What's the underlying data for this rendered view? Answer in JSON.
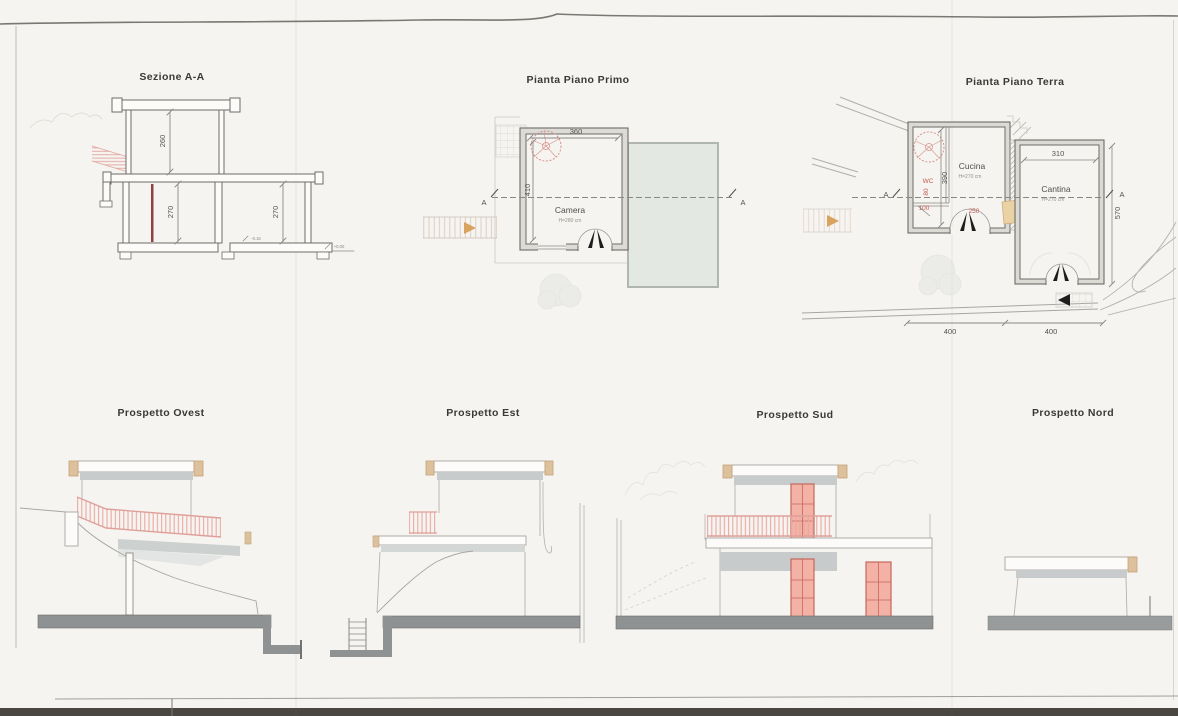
{
  "sheet": {
    "kind": "scanned architectural drawing sheet"
  },
  "colors": {
    "paper": "#f6f4f0",
    "line_dark": "#6e6c68",
    "line_light": "#a8a6a2",
    "title_ink": "#3b3936",
    "dim_ink": "#55534f",
    "red_ink": "#c05b52",
    "door_pink": "#f3b2a5",
    "door_outline": "#c4685c",
    "railing_pink": "#e9a9a2",
    "roof_tan": "#ddc09c",
    "fascia_gray": "#c7cbcc",
    "fascia_gray_light": "#d3d7d6",
    "terrace_gray": "#e4e8e3",
    "ground_gray": "#8e9293",
    "ground_gray_light": "#989c9d",
    "arrow_orange": "#d8a35e",
    "door_red_section": "#8f4341",
    "scan_edge_dark": "#4a4742"
  },
  "sezione": {
    "title": "Sezione A-A",
    "dim_upper": "260",
    "dim_lower_left": "270",
    "dim_lower_right": "270",
    "level_left": "-0.15",
    "level_right": "+0.00"
  },
  "primo": {
    "title": "Pianta Piano Primo",
    "dim_width": "360",
    "dim_depth": "410",
    "room_name": "Camera",
    "room_height": "H=280 cm",
    "section_a_left": "A",
    "section_a_right": "A"
  },
  "terra": {
    "title": "Pianta Piano Terra",
    "cucina_name": "Cucina",
    "cucina_height": "H=270 cm",
    "cantina_name": "Cantina",
    "cantina_height": "H=270 cm",
    "wc_label": "WC",
    "dim_wc_width": "80",
    "dim_entry": "100",
    "dim_door": "250",
    "dim_cucina_depth": "390",
    "dim_cantina_width": "310",
    "dim_site_depth": "570",
    "dim_bottom_left": "400",
    "dim_bottom_right": "400",
    "section_a_left": "A",
    "section_a_right": "A"
  },
  "ovest": {
    "title": "Prospetto Ovest"
  },
  "est": {
    "title": "Prospetto Est"
  },
  "sud": {
    "title": "Prospetto Sud"
  },
  "nord": {
    "title": "Prospetto Nord"
  }
}
